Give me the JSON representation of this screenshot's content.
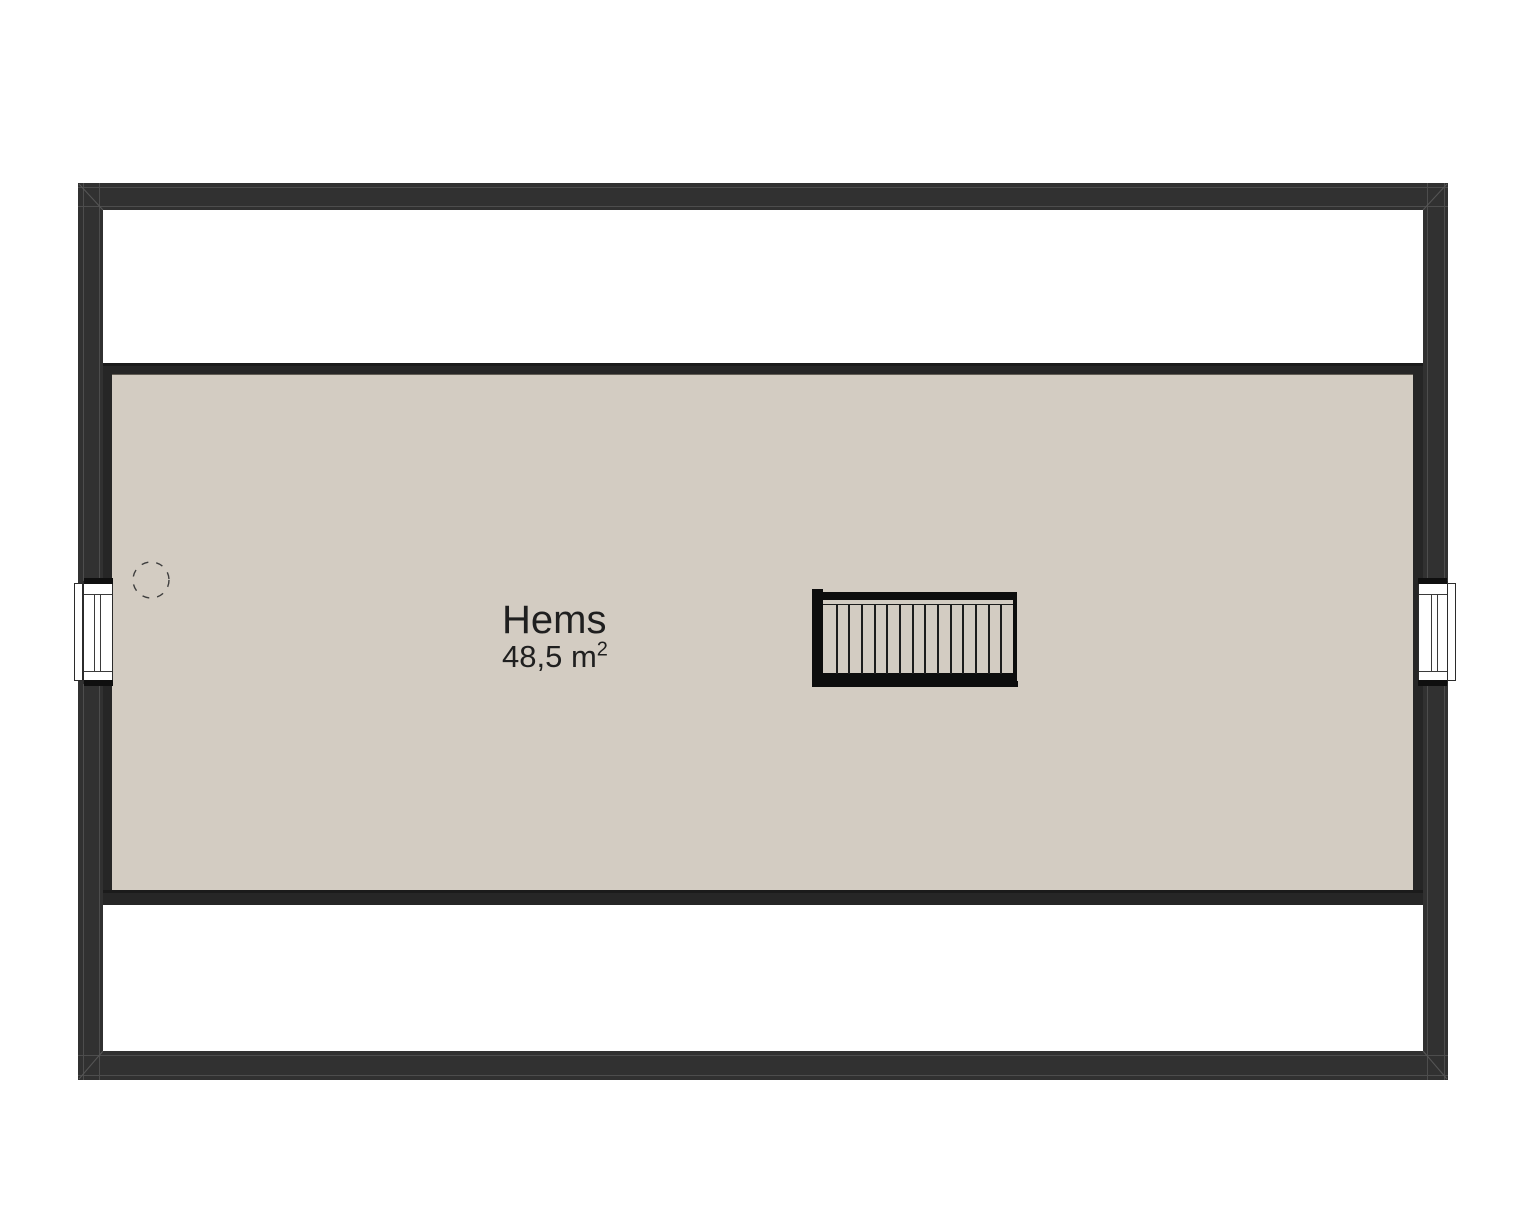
{
  "plan": {
    "room": {
      "label": "Hems",
      "area_text": "48,5 m",
      "area_exponent": "2"
    },
    "stair": {
      "tread_count": 14
    },
    "colors": {
      "background": "#ffffff",
      "wall": "#313131",
      "wall_band": "#262626",
      "seam": "#4d4d4d",
      "floor": "#d3ccc2",
      "text": "#1f1f1f"
    }
  }
}
